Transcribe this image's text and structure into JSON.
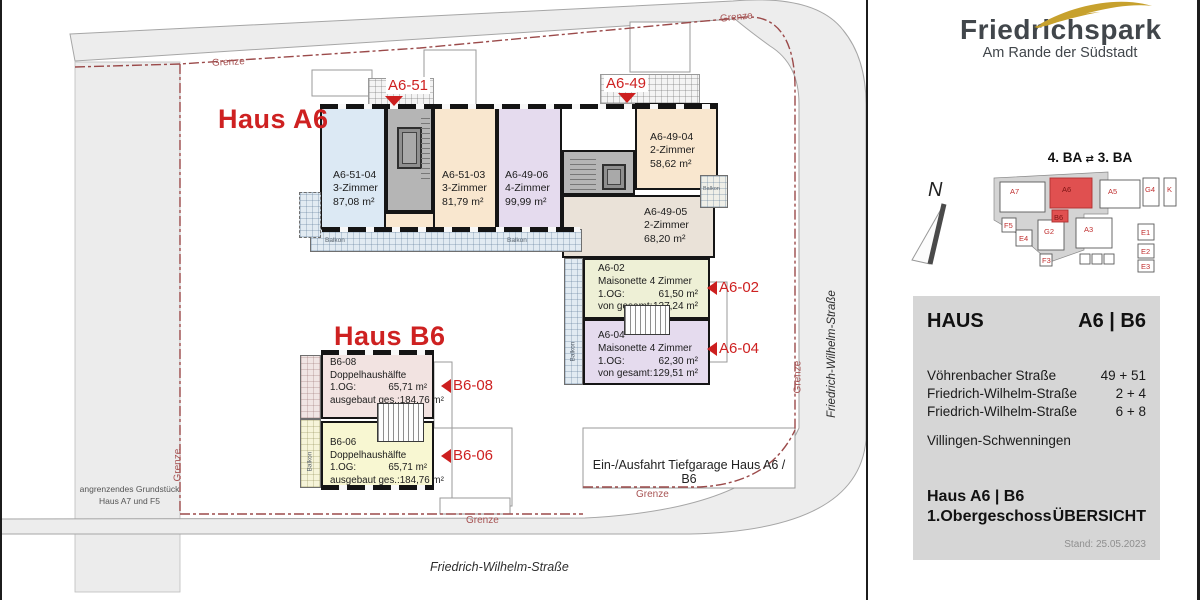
{
  "colors": {
    "accent_red": "#ce2121",
    "grenze_red": "#9b4a4a",
    "logo_gold": "#c7a12d",
    "panel_gray": "#d6d6d6",
    "room_blue": "#dce9f4",
    "room_cream": "#f9e7cf",
    "room_lavender": "#e5dbee",
    "room_beige": "#eae2d8",
    "room_green": "#eef0d6",
    "room_pink": "#f2e3e1",
    "room_yellow": "#f8f7d2"
  },
  "logo": {
    "title": "Friedrichspark",
    "subtitle": "Am Rande der Südstadt"
  },
  "minimap": {
    "phase_left": "4. BA",
    "swap_icon": "⇄",
    "phase_right": "3. BA",
    "buildings": [
      "A7",
      "A6",
      "B6",
      "A5",
      "G4",
      "K",
      "F5",
      "E4",
      "G2",
      "A3",
      "F3",
      "E1",
      "E2",
      "E3"
    ]
  },
  "compass": {
    "north": "N"
  },
  "info_panel": {
    "haus_label": "HAUS",
    "haus_value": "A6 | B6",
    "addresses": [
      {
        "street": "Vöhrenbacher Straße",
        "numbers": "49 + 51"
      },
      {
        "street": "Friedrich-Wilhelm-Straße",
        "numbers": "2 + 4"
      },
      {
        "street": "Friedrich-Wilhelm-Straße",
        "numbers": "6 + 8"
      }
    ],
    "city": "Villingen-Schwenningen",
    "building": "Haus A6 | B6",
    "floor": "1.Obergeschoss",
    "view": "ÜBERSICHT",
    "date": "Stand: 25.05.2023"
  },
  "plan": {
    "titles": {
      "haus_a6": "Haus A6",
      "haus_b6": "Haus B6"
    },
    "entrances": [
      {
        "label": "A6-51"
      },
      {
        "label": "A6-49"
      }
    ],
    "markers": [
      {
        "label": "A6-02"
      },
      {
        "label": "A6-04"
      },
      {
        "label": "B6-08"
      },
      {
        "label": "B6-06"
      }
    ],
    "apartments": [
      {
        "id": "A6-51-04",
        "rooms": "3-Zimmer",
        "area": "87,08 m²"
      },
      {
        "id": "A6-51-03",
        "rooms": "3-Zimmer",
        "area": "81,79 m²"
      },
      {
        "id": "A6-49-06",
        "rooms": "4-Zimmer",
        "area": "99,99 m²"
      },
      {
        "id": "A6-49-04",
        "rooms": "2-Zimmer",
        "area": "58,62 m²"
      },
      {
        "id": "A6-49-05",
        "rooms": "2-Zimmer",
        "area": "68,20 m²"
      },
      {
        "id": "A6-02",
        "type": "Maisonette 4 Zimmer",
        "floor_label": "1.OG:",
        "floor_area": "61,50 m²",
        "total_label": "von gesamt:",
        "total_area": "127,24 m²"
      },
      {
        "id": "A6-04",
        "type": "Maisonette 4 Zimmer",
        "floor_label": "1.OG:",
        "floor_area": "62,30 m²",
        "total_label": "von gesamt:",
        "total_area": "129,51 m²"
      },
      {
        "id": "B6-08",
        "type": "Doppelhaushälfte",
        "floor_label": "1.OG:",
        "floor_area": "65,71 m²",
        "total_label": "ausgebaut ges.:",
        "total_area": "184,76 m²"
      },
      {
        "id": "B6-06",
        "type": "Doppelhaushälfte",
        "floor_label": "1.OG:",
        "floor_area": "65,71 m²",
        "total_label": "ausgebaut ges.:",
        "total_area": "184,76 m²"
      }
    ],
    "labels": {
      "garage": "Ein-/Ausfahrt Tiefgarage Haus A6 / B6",
      "adjacent_line1": "angrenzendes Grundstück",
      "adjacent_line2": "Haus  A7 und F5",
      "street": "Friedrich-Wilhelm-Straße",
      "grenze": "Grenze",
      "balkon": "Balkon"
    }
  }
}
